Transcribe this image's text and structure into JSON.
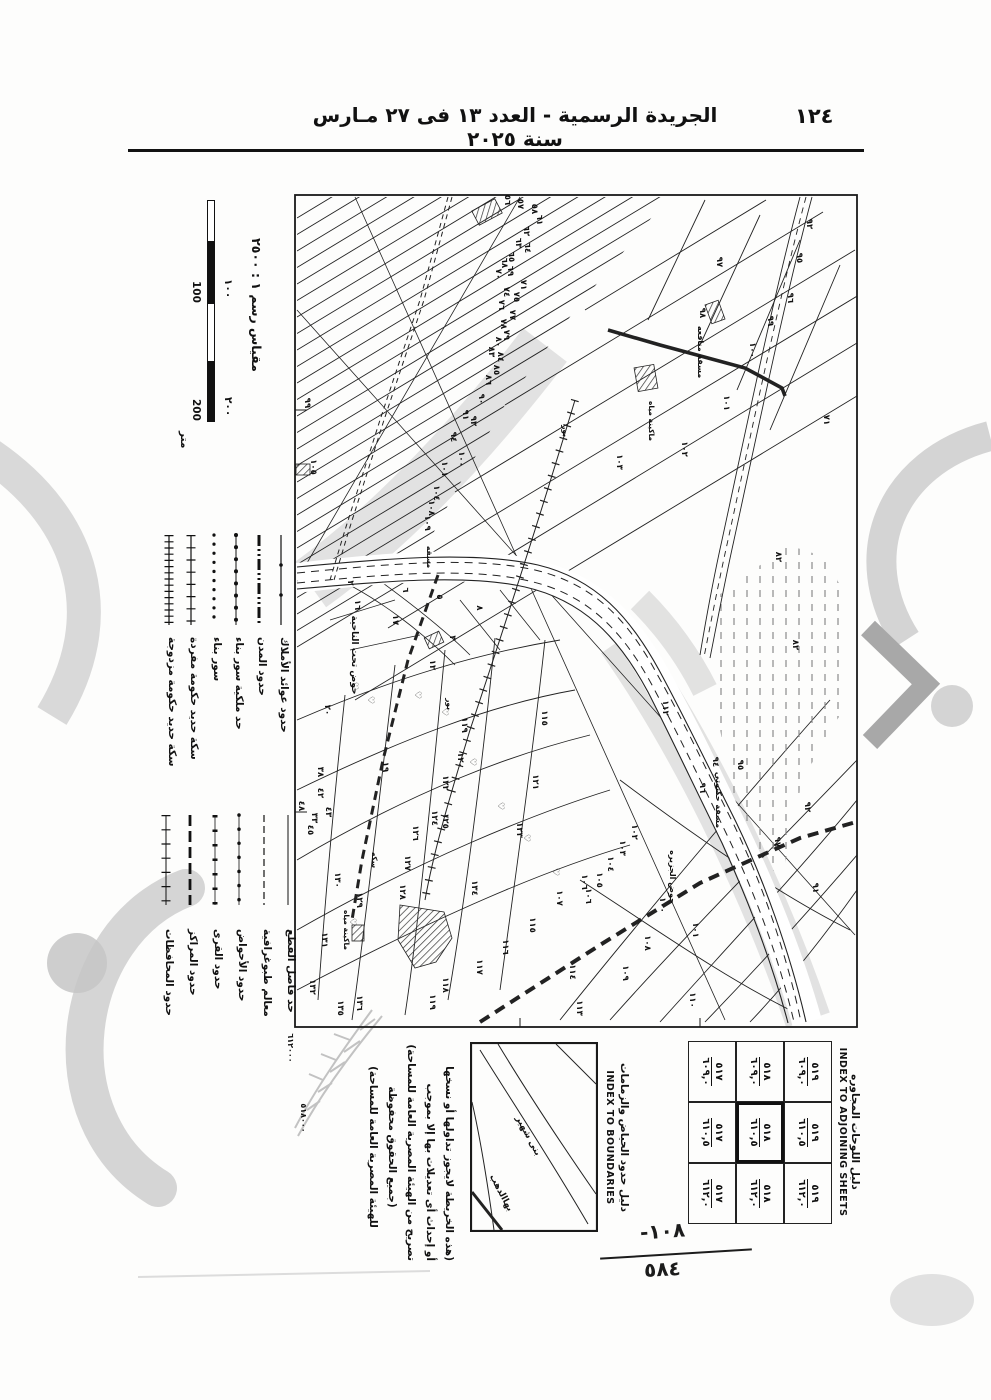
{
  "page": {
    "header": {
      "title": "الجريدة الرسمية - العدد ١٣ فى ٢٧ مـارس سنة ٢٠٢٥",
      "page_number": "١٢٤"
    },
    "hand_annotation": {
      "top": "-١٠٨",
      "bottom": "٥٨٤"
    }
  },
  "map_sheet": {
    "scale": {
      "title": "مقياس رسم ١ : ٢٥٠٠",
      "upper": [
        "١٠٠",
        "٢٠٠"
      ],
      "lower": [
        "100",
        "200"
      ],
      "unit": "متر"
    },
    "legend": {
      "groups": [
        {
          "rows": [
            {
              "label": "حدود عوائد الأملاك",
              "sym": "dotline"
            },
            {
              "label": "حدود المدن",
              "sym": "city"
            },
            {
              "label": "حد ملكية سور بناء",
              "sym": "beads"
            },
            {
              "label": "سور بناء",
              "sym": "dots"
            },
            {
              "label": "سكة حديد حكومة مفردة",
              "sym": "rail1"
            },
            {
              "label": "سكة حديد حكومة مزدوجة",
              "sym": "rail2"
            }
          ]
        },
        {
          "rows": [
            {
              "label": "حد فاصل القطع",
              "sym": "thin"
            },
            {
              "label": "معالم طبوغرافية",
              "sym": "dash"
            },
            {
              "label": "حدود الأحواض",
              "sym": "beads2"
            },
            {
              "label": "حدود القرى",
              "sym": "tri"
            },
            {
              "label": "حدود المراكز",
              "sym": "heavy"
            },
            {
              "label": "حدود المحافظات",
              "sym": "cross"
            }
          ]
        }
      ]
    },
    "adjoining": {
      "title_ar": "دليل اللوحات المجاوره",
      "title_en": "INDEX TO ADJOINING SHEETS",
      "grid": [
        [
          {
            "top": "٥١٩",
            "bottom": "٦٠٩,٠"
          },
          {
            "top": "٥١٩",
            "bottom": "٦١٠,٥"
          },
          {
            "top": "٥١٩",
            "bottom": "٦١٢,٠"
          }
        ],
        [
          {
            "top": "٥١٨",
            "bottom": "٦٠٩,٠"
          },
          {
            "top": "٥١٨",
            "bottom": "٦١٠,٥"
          },
          {
            "top": "٥١٨",
            "bottom": "٦١٢,٠"
          }
        ],
        [
          {
            "top": "٥١٧",
            "bottom": "٦٠٩,٠"
          },
          {
            "top": "٥١٧",
            "bottom": "٦١٠,٥"
          },
          {
            "top": "٥١٧",
            "bottom": "٦١٢,٠"
          }
        ]
      ],
      "current_row": 1,
      "current_col": 1
    },
    "boundaries_index": {
      "title_ar": "دليل حدود الحياض والزمامات",
      "title_en": "INDEX TO BOUNDARIES",
      "labels": [
        "بنى شهير",
        "بهاالدهب"
      ]
    },
    "notes_lines": [
      "(هذه الخريطة لايجوز تداولها أو نسخها",
      "أو إحداث أى تعديلات بها إلا بموجب",
      "تصريح من الهيئة المصرية العامة للمساحة)",
      "(جميع الحقوق محفوظة",
      "للهيئة المصرية العامة للمساحة)"
    ],
    "feature_labels": [
      [
        "حوض تحت الناحية",
        352,
        655,
        9
      ],
      [
        "مسقة منافعه",
        698,
        352,
        8
      ],
      [
        "ماكينة مياه",
        649,
        421,
        7.5
      ],
      [
        "مسقة حكنوتي",
        716,
        800,
        8
      ],
      [
        "حوض الجزيره",
        670,
        877,
        8
      ],
      [
        "سكه",
        372,
        860,
        7.5
      ],
      [
        "ماكينة مياه",
        344,
        930,
        7.5
      ],
      [
        "بور",
        447,
        704,
        7.5
      ],
      [
        "بور",
        563,
        431,
        7.5
      ],
      [
        "مسقه",
        427,
        557,
        7.5
      ],
      [
        "٥١٨٠٠٠",
        301,
        1118,
        8
      ],
      [
        "٦١٢٠٠٠",
        288,
        1048,
        8
      ],
      [
        "٩٩",
        305,
        403,
        8.5
      ],
      [
        "٤٨",
        299,
        806,
        8.5
      ]
    ],
    "parcel_labels": [
      [
        "٥٦",
        505,
        200
      ],
      [
        "٥٧",
        518,
        204
      ],
      [
        "٥٨",
        532,
        209
      ],
      [
        "٦١",
        537,
        220
      ],
      [
        "٦٢",
        524,
        231
      ],
      [
        "٦٣",
        516,
        243
      ],
      [
        "٦٤",
        525,
        248
      ],
      [
        "٦٥",
        509,
        257
      ],
      [
        "٦٨",
        502,
        263
      ],
      [
        "٦٩",
        508,
        271
      ],
      [
        "٧٠",
        496,
        274
      ],
      [
        "٧١",
        521,
        285
      ],
      [
        "٧٤",
        504,
        292
      ],
      [
        "٧٥",
        514,
        297
      ],
      [
        "٧٦",
        499,
        305
      ],
      [
        "٧٧",
        510,
        315
      ],
      [
        "٧٨",
        501,
        324
      ],
      [
        "٧٩",
        504,
        335
      ],
      [
        "٨٠",
        496,
        342
      ],
      [
        "٨٣",
        489,
        352
      ],
      [
        "٨٤",
        498,
        357
      ],
      [
        "٨٥",
        494,
        370
      ],
      [
        "٨٦",
        486,
        380
      ],
      [
        "٩٠",
        479,
        399
      ],
      [
        "٩١",
        463,
        415
      ],
      [
        "٩٢",
        471,
        421
      ],
      [
        "٩٤",
        451,
        437
      ],
      [
        "١٠٠",
        459,
        459
      ],
      [
        "١٠١",
        442,
        469
      ],
      [
        "١٠٤",
        434,
        493
      ],
      [
        "١٠٨",
        429,
        508
      ],
      [
        "١٠٩",
        425,
        523
      ],
      [
        "١٠٥",
        311,
        467
      ],
      [
        "٩٢",
        807,
        224
      ],
      [
        "٩٥",
        797,
        258
      ],
      [
        "٩٦",
        788,
        298
      ],
      [
        "٩٧",
        717,
        262
      ],
      [
        "٩٨",
        700,
        313
      ],
      [
        "٩٩",
        768,
        321
      ],
      [
        "١٠٠",
        750,
        350
      ],
      [
        "١٠١",
        724,
        403
      ],
      [
        "١٠٢",
        682,
        449
      ],
      [
        "١٠٣",
        617,
        462
      ],
      [
        "٧١",
        824,
        420
      ],
      [
        "٨٢",
        776,
        557
      ],
      [
        "٨٢",
        793,
        645
      ],
      [
        "٢",
        348,
        583
      ],
      [
        "٥",
        437,
        597
      ],
      [
        "٦",
        403,
        590
      ],
      [
        "٨",
        477,
        608
      ],
      [
        "٣",
        450,
        638
      ],
      [
        "١٢",
        430,
        665
      ],
      [
        "١٦",
        355,
        605
      ],
      [
        "١٧",
        393,
        620
      ],
      [
        "٢٠",
        325,
        710
      ],
      [
        "١٩",
        383,
        767
      ],
      [
        "٣٨",
        318,
        772
      ],
      [
        "٤٢",
        318,
        793
      ],
      [
        "٤٣",
        326,
        812
      ],
      [
        "٣٣",
        312,
        818
      ],
      [
        "٤٥",
        308,
        830
      ],
      [
        "١١٥",
        542,
        718
      ],
      [
        "١١٩",
        462,
        725
      ],
      [
        "١٢٠",
        458,
        760
      ],
      [
        "١٢١",
        533,
        782
      ],
      [
        "١٢٢",
        443,
        783
      ],
      [
        "١٢٤",
        432,
        818
      ],
      [
        "١٢٥",
        443,
        821
      ],
      [
        "١٢٣",
        517,
        830
      ],
      [
        "١٢٦",
        413,
        833
      ],
      [
        "١٢٧",
        405,
        863
      ],
      [
        "١٢٨",
        400,
        892
      ],
      [
        "١٢٩",
        357,
        900
      ],
      [
        "١٣٠",
        335,
        880
      ],
      [
        "١٣٤",
        472,
        888
      ],
      [
        "١٣١",
        322,
        940
      ],
      [
        "١٣٦",
        357,
        1003
      ],
      [
        "١٣٢",
        310,
        987
      ],
      [
        "١٣٥",
        338,
        1008
      ],
      [
        "١١٦",
        503,
        947
      ],
      [
        "١١٧",
        477,
        967
      ],
      [
        "١١٨",
        443,
        985
      ],
      [
        "١١٩",
        430,
        1002
      ],
      [
        "١١٥",
        530,
        925
      ],
      [
        "١٠٦",
        582,
        882
      ],
      [
        "١٠٧",
        557,
        898
      ],
      [
        "٩١",
        813,
        888
      ],
      [
        "٩٢",
        805,
        807
      ],
      [
        "٩٤",
        713,
        762
      ],
      [
        "٩٥",
        738,
        765
      ],
      [
        "٩٦",
        700,
        788
      ],
      [
        "٩٧",
        775,
        842
      ],
      [
        "١٠٠",
        660,
        905
      ],
      [
        "١٠١",
        693,
        930
      ],
      [
        "١٠٢",
        632,
        832
      ],
      [
        "١٠٣",
        620,
        848
      ],
      [
        "١٠٤",
        608,
        864
      ],
      [
        "١٠٥",
        597,
        880
      ],
      [
        "١٠٦",
        586,
        896
      ],
      [
        "١٠٨",
        645,
        943
      ],
      [
        "١٠٩",
        623,
        973
      ],
      [
        "١١٠",
        690,
        1000
      ],
      [
        "١١٣",
        577,
        1008
      ],
      [
        "١١٤",
        570,
        972
      ],
      [
        "١١٢",
        663,
        708
      ]
    ],
    "tree_symbols": {
      "glyph": "♡",
      "positions": [
        [
          352,
          686
        ],
        [
          368,
          700
        ],
        [
          415,
          695
        ],
        [
          442,
          712
        ],
        [
          470,
          762
        ],
        [
          498,
          806
        ],
        [
          524,
          838
        ],
        [
          350,
          922
        ],
        [
          553,
          872
        ]
      ]
    }
  }
}
